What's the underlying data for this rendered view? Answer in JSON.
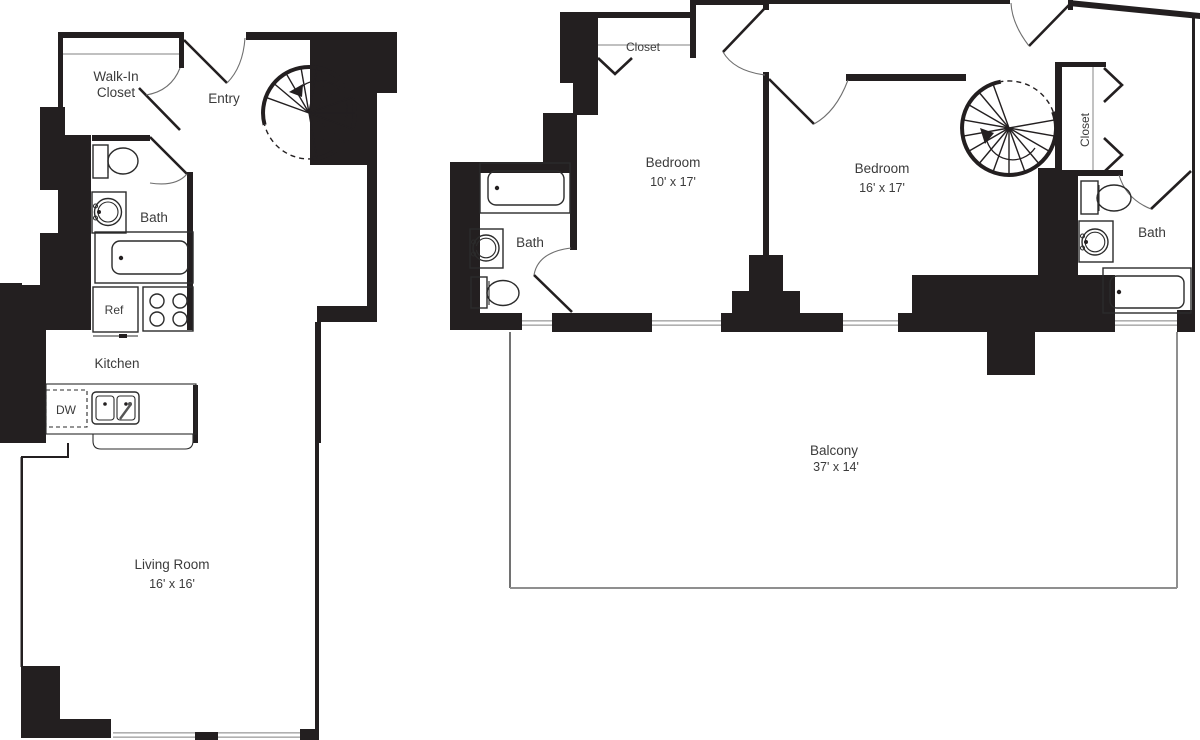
{
  "title": "Two-level apartment floor plan",
  "colors": {
    "wall": "#231f20",
    "fixture_line": "#2b2b2b",
    "window_line": "#b0b0b0",
    "text": "#3b3b3b",
    "background": "#ffffff"
  },
  "lower_level": {
    "walk_in_closet_line1": "Walk-In",
    "walk_in_closet_line2": "Closet",
    "entry": "Entry",
    "bath": "Bath",
    "refrigerator": "Ref",
    "kitchen": "Kitchen",
    "dishwasher": "DW",
    "living_room": "Living Room",
    "living_room_dims": "16' x 16'"
  },
  "upper_level": {
    "closet_top": "Closet",
    "bedroom_small": "Bedroom",
    "bedroom_small_dims": "10' x 17'",
    "bedroom_large": "Bedroom",
    "bedroom_large_dims": "16' x 17'",
    "closet_right": "Closet",
    "bath_left": "Bath",
    "bath_right": "Bath",
    "balcony": "Balcony",
    "balcony_dims": "37' x 14'"
  }
}
